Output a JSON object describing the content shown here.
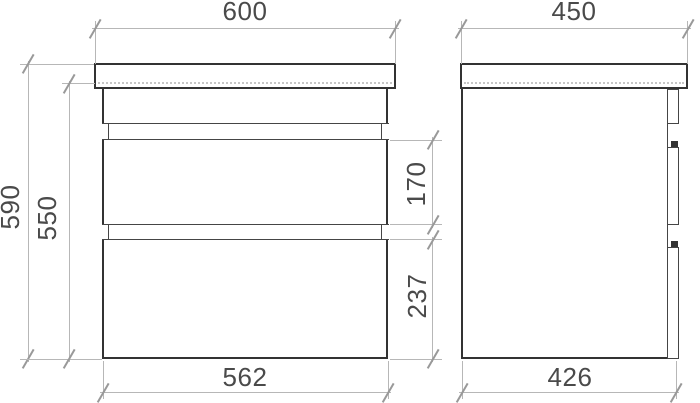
{
  "drawing": {
    "description": "Two-view technical dimension drawing of a wall-hung vanity cabinet with countertop and two drawers",
    "views": {
      "front": "front-view",
      "side": "side-view"
    }
  },
  "dims": {
    "top_width": "600",
    "top_depth": "450",
    "total_height": "590",
    "body_height": "550",
    "drawer1_height": "170",
    "drawer2_height": "237",
    "bottom_width": "562",
    "bottom_depth": "426"
  },
  "colors": {
    "bg": "#ffffff",
    "obj": "#333333",
    "obj2": "#454545",
    "dim": "#b7b7b7",
    "tick": "#999999",
    "dot": "#c6c6c6",
    "txt": "#4a4a4a"
  }
}
